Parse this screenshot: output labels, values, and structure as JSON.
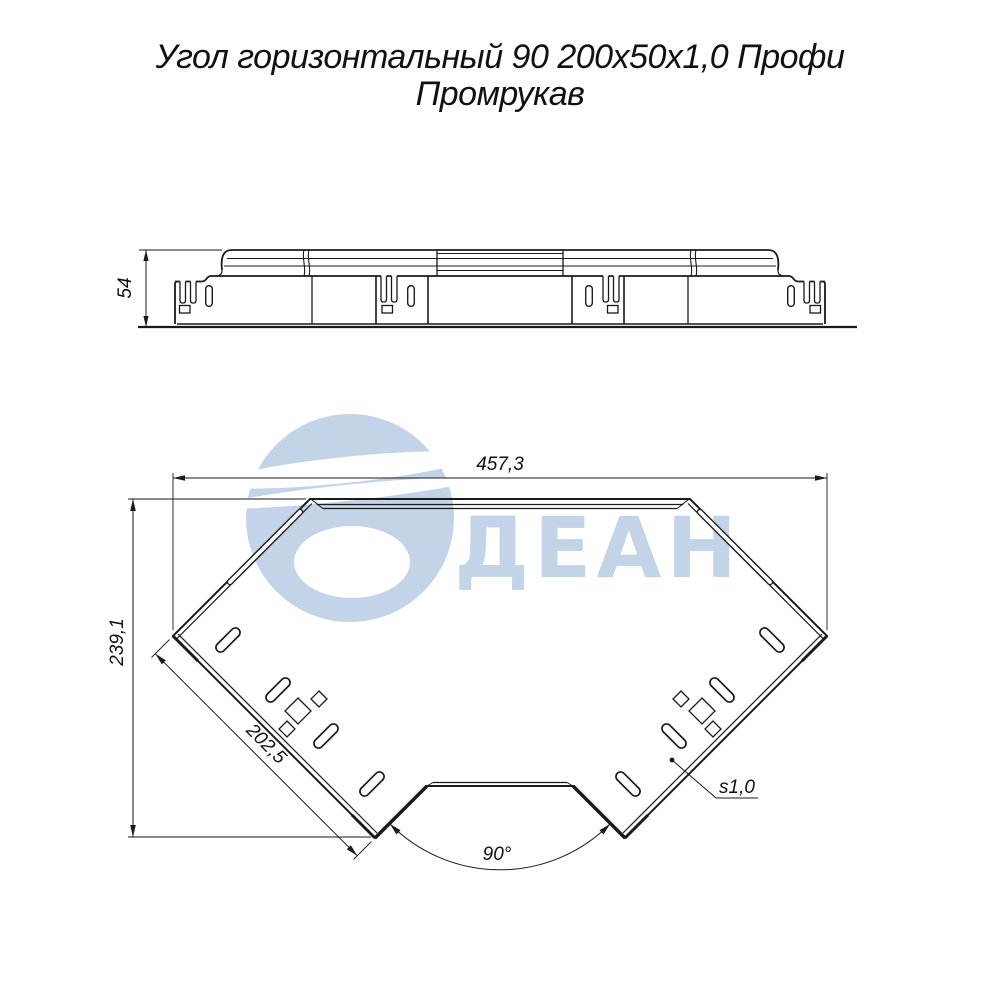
{
  "title": {
    "line1": "Угол горизонтальный 90 200х50х1,0 Профи",
    "line2": "Промрукав"
  },
  "watermark": {
    "text": "ДЕАН",
    "color": "#bdd0e7"
  },
  "side_view": {
    "description": "side elevation of cable tray 90deg horizontal angle",
    "dims": {
      "height": "54"
    }
  },
  "plan_view": {
    "description": "top view of cable tray 90deg horizontal angle",
    "dims": {
      "overall_width": "457,3",
      "overall_depth": "239,1",
      "end_width": "202,5",
      "angle": "90°",
      "thickness": "s1,0"
    }
  },
  "colors": {
    "line": "#1a1a1a",
    "background": "#ffffff",
    "watermark": "#bdd0e7"
  }
}
